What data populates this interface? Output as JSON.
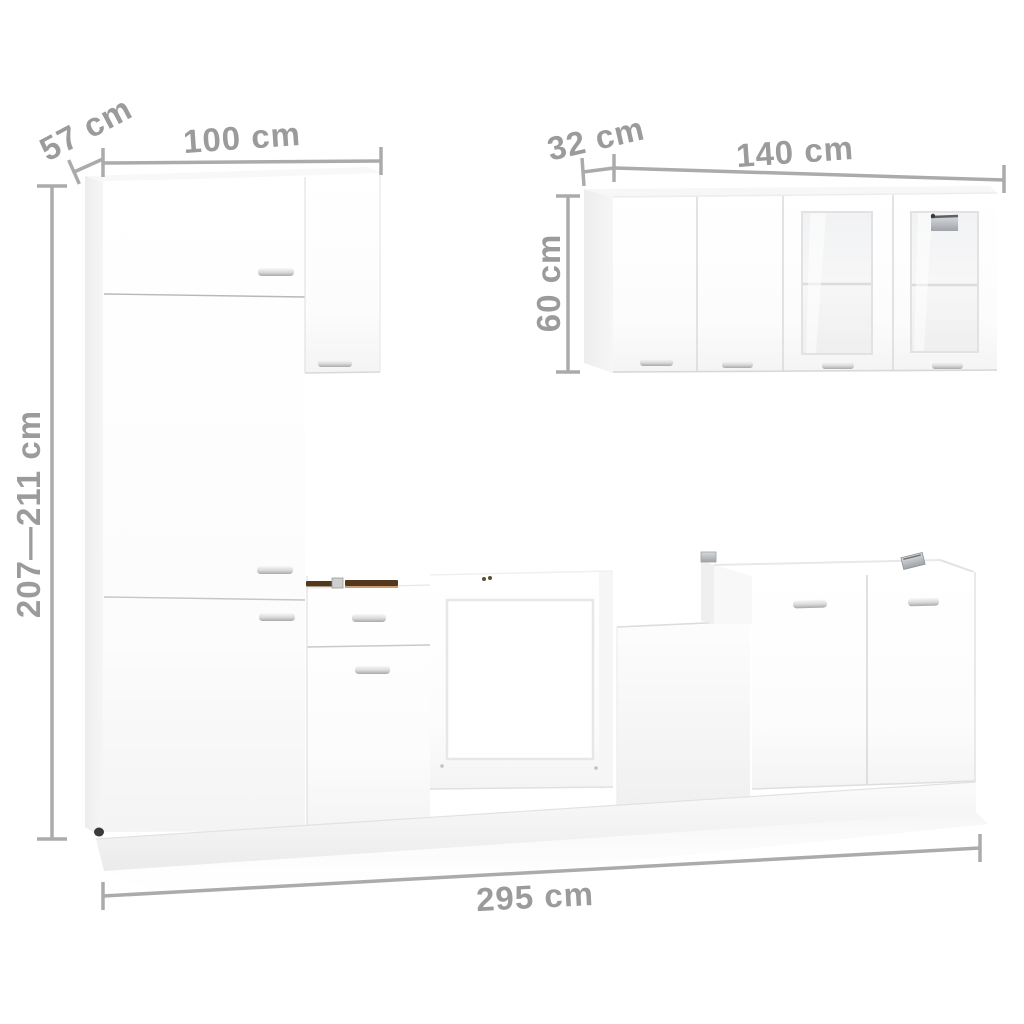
{
  "diagram": {
    "type": "kitchen-cabinet-set-dimension-diagram",
    "dimensions": {
      "tall_unit_depth": "57 cm",
      "tall_unit_width": "100 cm",
      "wall_unit_depth": "32 cm",
      "wall_unit_width": "140 cm",
      "wall_unit_height": "60 cm",
      "tall_unit_height_range": "207—211 cm",
      "total_width": "295 cm"
    },
    "colors": {
      "background": "#ffffff",
      "cabinet_white": "#ffffff",
      "cabinet_shade": "#f1f1f1",
      "dimension_text": "#9b9b9b",
      "dimension_line": "#ababab",
      "exposed_board_edge": "#54381e",
      "metal_hardware": "#c2c4c8"
    }
  }
}
